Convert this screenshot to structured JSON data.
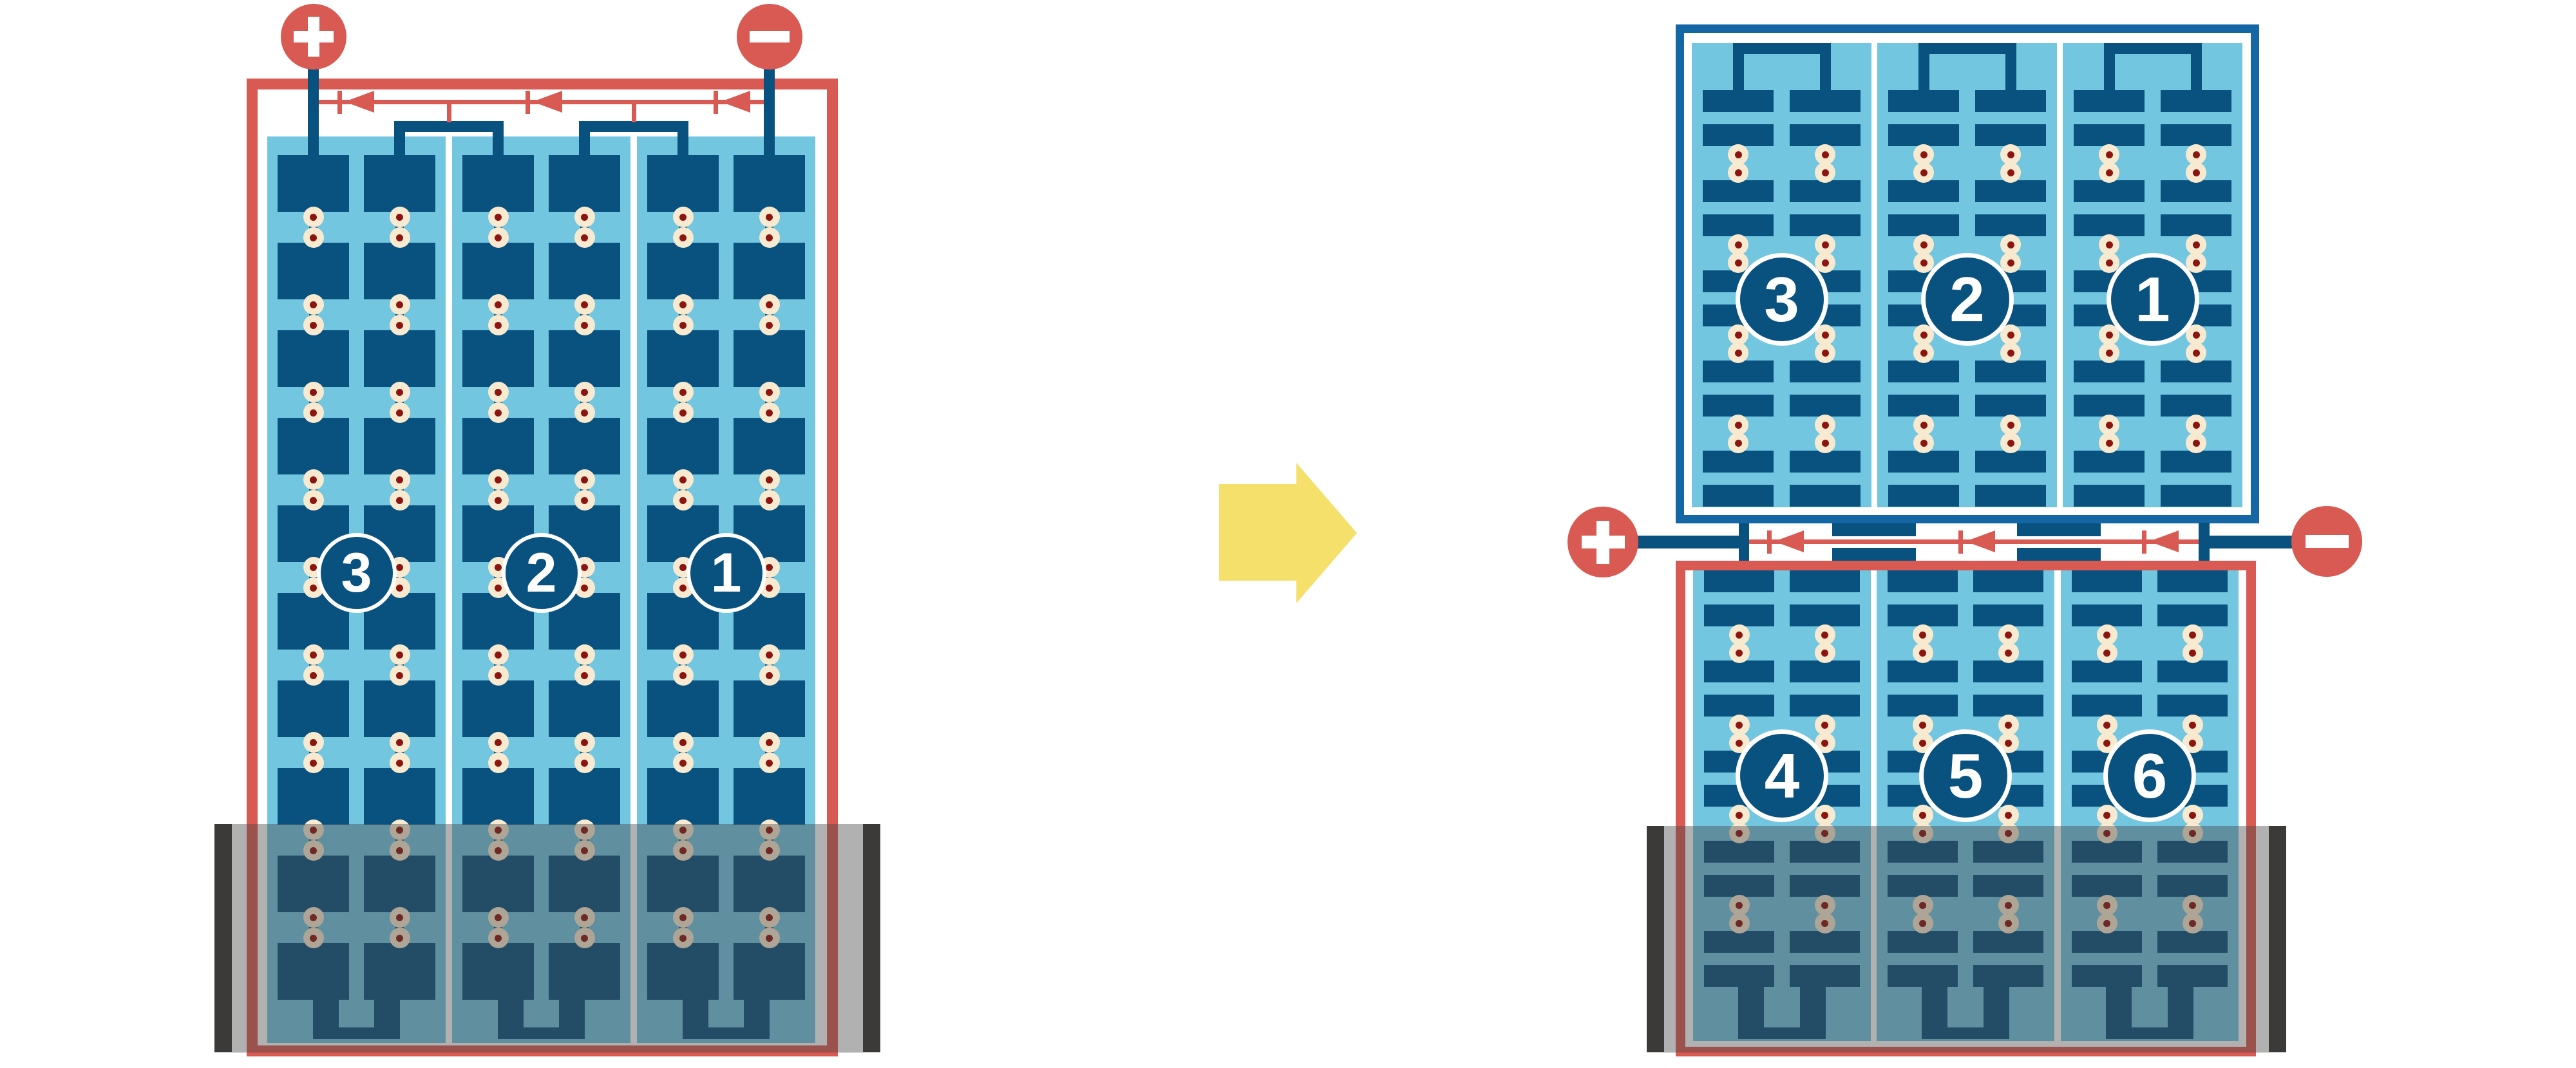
{
  "diagram": {
    "description": "battery block rearrangement diagram: one tall 3-cell block becomes two stacked 3-cell blocks wired in series",
    "left_block": {
      "cells": [
        {
          "label": "3"
        },
        {
          "label": "2"
        },
        {
          "label": "1"
        }
      ],
      "plate_rows": 10,
      "plate_columns_per_cell": 2,
      "flow_arrows": 3,
      "positive_terminal": "+",
      "negative_terminal": "-"
    },
    "transform_arrow": {
      "direction": "right"
    },
    "right_top_block": {
      "cells": [
        {
          "label": "3"
        },
        {
          "label": "2"
        },
        {
          "label": "1"
        }
      ],
      "plate_rows": 10,
      "plate_columns_per_cell": 2
    },
    "right_bottom_block": {
      "cells": [
        {
          "label": "4"
        },
        {
          "label": "5"
        },
        {
          "label": "6"
        }
      ],
      "plate_rows": 10,
      "plate_columns_per_cell": 2,
      "flow_arrows": 3,
      "positive_terminal": "+",
      "negative_terminal": "-"
    },
    "colors": {
      "red": "#d85a52",
      "navy": "#09527f",
      "frame_blue": "#1566a4",
      "light_blue": "#72c6e0",
      "cream": "#f8ead0",
      "dot_red": "#8c160f",
      "yellow": "#f4e06a",
      "wall_gray": "#3b3a39",
      "tray_overlay": "rgba(72,70,68,0.42)",
      "white": "#ffffff"
    }
  }
}
